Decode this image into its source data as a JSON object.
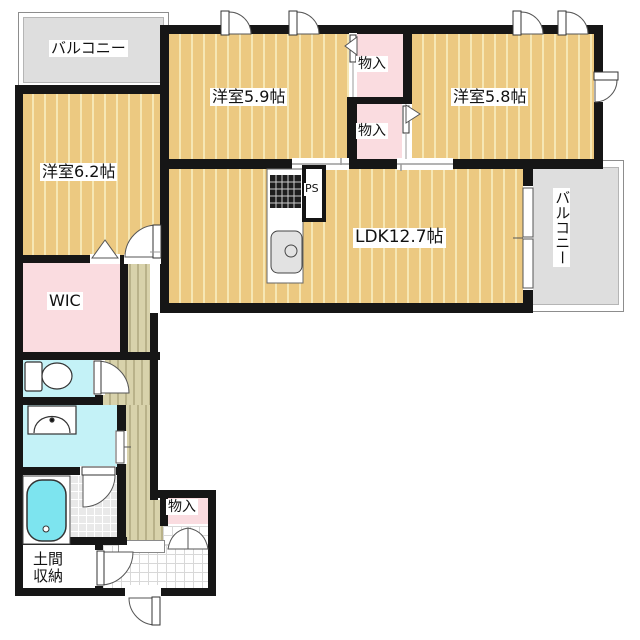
{
  "labels": {
    "balcony_top": "バルコニー",
    "balcony_right": "バルコニー",
    "bedroom59": "洋室5.9帖",
    "bedroom58": "洋室5.8帖",
    "bedroom62": "洋室6.2帖",
    "ldk": "LDK12.7帖",
    "closet1": "物入",
    "closet2": "物入",
    "closet_entry": "物入",
    "wic": "WIC",
    "ps": "PS",
    "doma_line1": "土間",
    "doma_line2": "収納"
  },
  "colors": {
    "wall": "#161616",
    "floor": "#ecc981",
    "floor_stripe": "#f6e7b4",
    "wood": "#d8d2ab",
    "wood_stripe": "#b9b28a",
    "pink": "#fadce0",
    "cyan": "#c4f2f7",
    "tub": "#7de4ef",
    "balcony": "#dedede"
  }
}
